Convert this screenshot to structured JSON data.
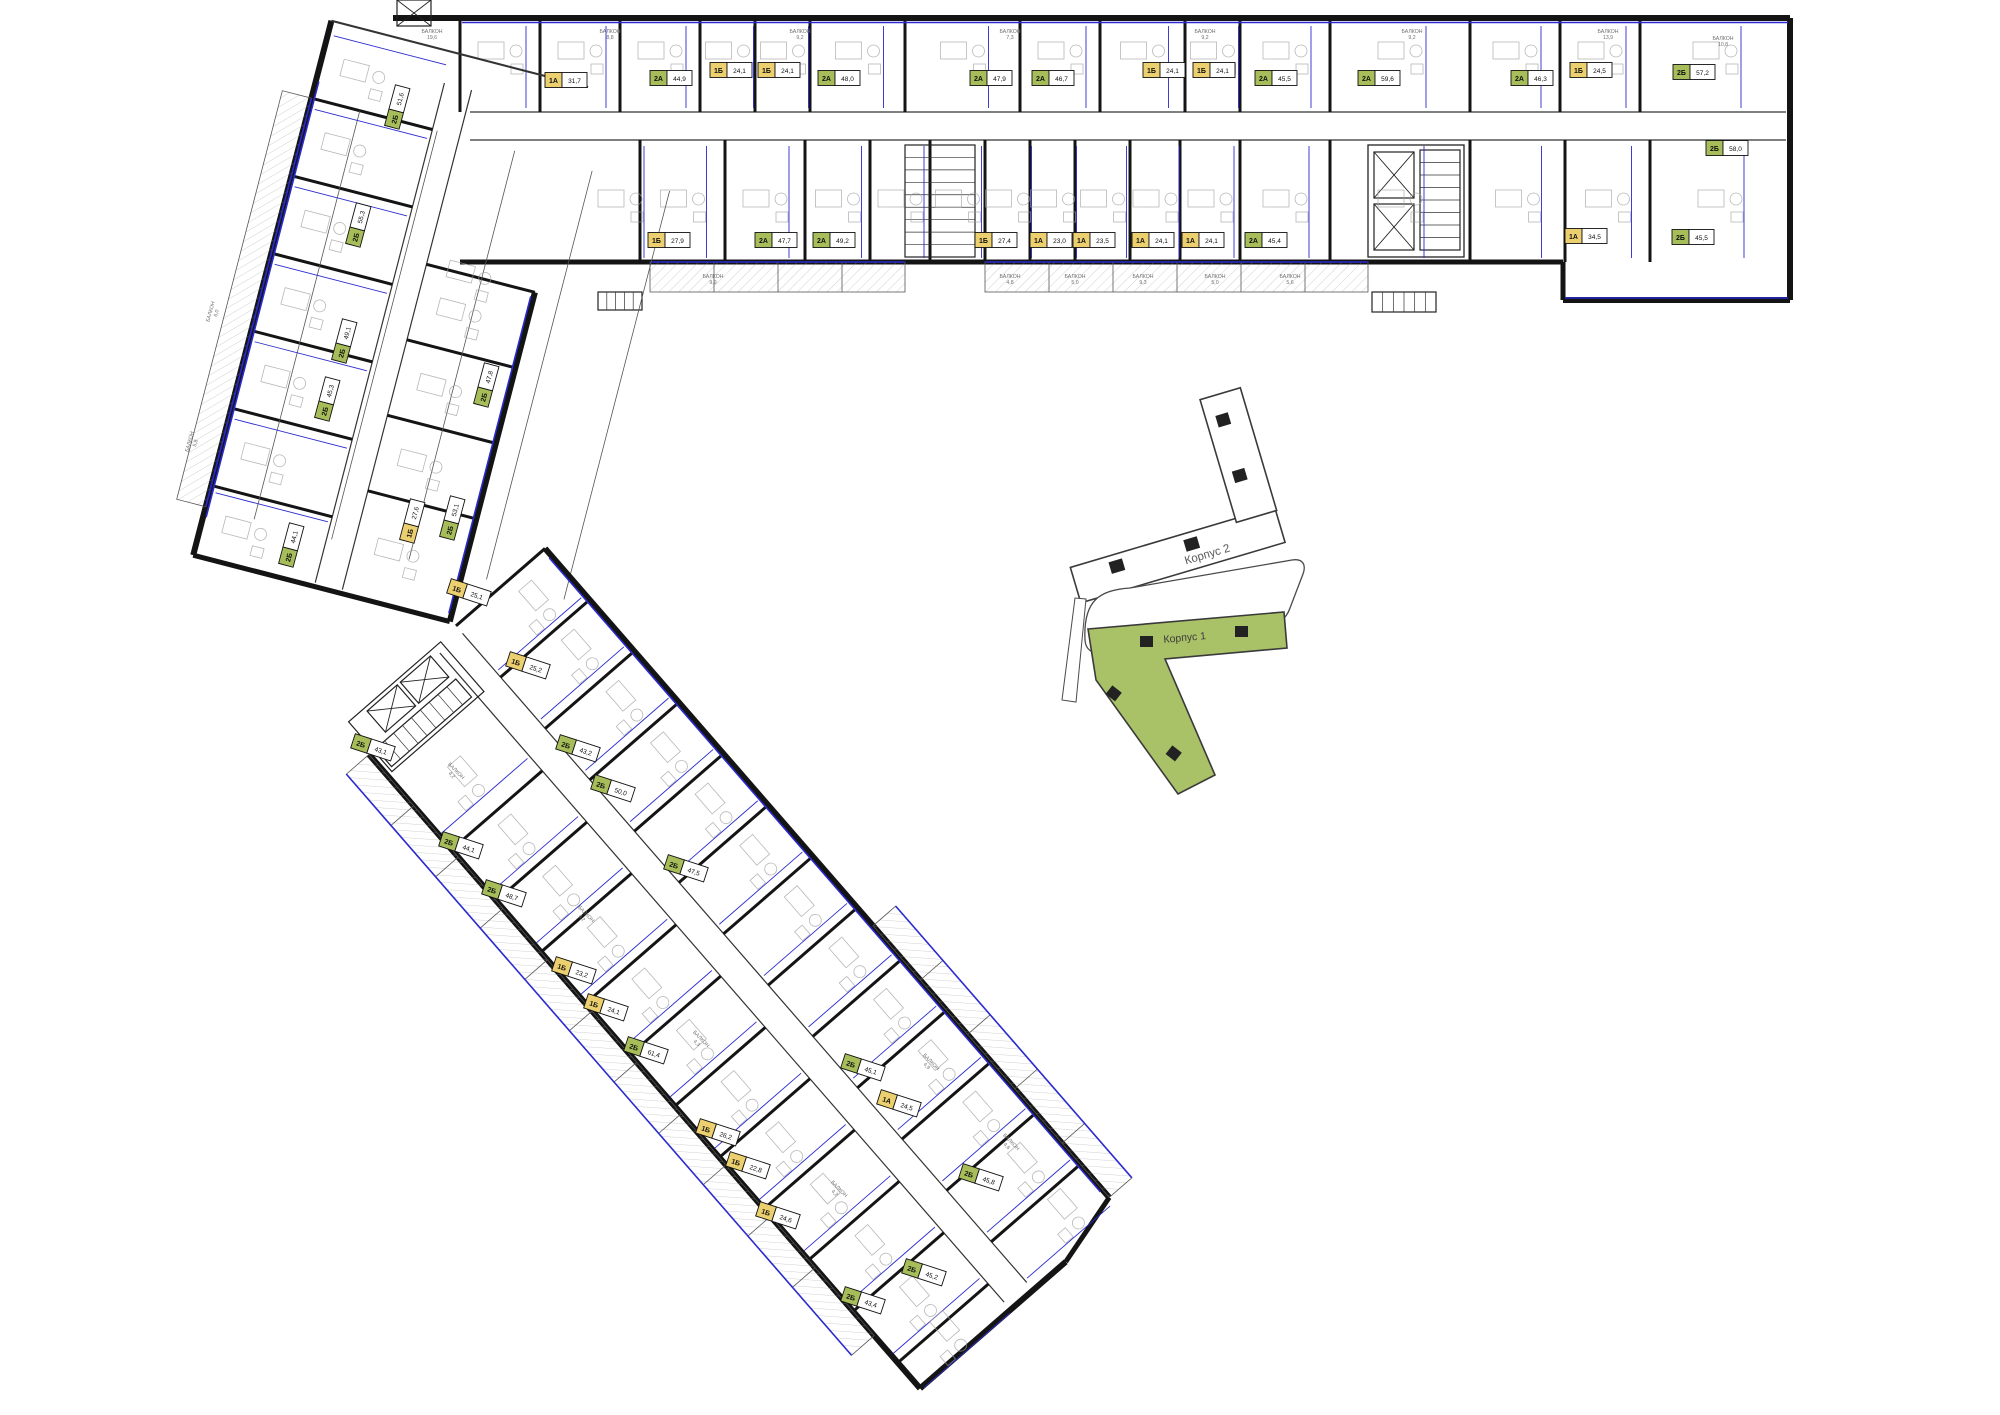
{
  "title": "Поэтажный план — Корпус 1",
  "key_plan": {
    "building1_label": "Корпус 1",
    "building2_label": "Корпус 2",
    "highlight_color": "#a9c167"
  },
  "colors": {
    "wall": "#141414",
    "thin": "#555555",
    "window_blue": "#2a2ad0",
    "type1_yellow": "#ecd06f",
    "type2_green": "#a6bd59",
    "balcony_text": "#707070",
    "furniture": "#a0a0a0"
  },
  "balcony_label": "БАЛКОН",
  "units": [
    {
      "t": "1А",
      "a": "31,7",
      "x": 565,
      "y": 80,
      "r": 0
    },
    {
      "t": "2А",
      "a": "44,9",
      "x": 670,
      "y": 78,
      "r": 0
    },
    {
      "t": "1Б",
      "a": "24,1",
      "x": 730,
      "y": 70,
      "r": 0
    },
    {
      "t": "1Б",
      "a": "24,1",
      "x": 778,
      "y": 70,
      "r": 0
    },
    {
      "t": "2А",
      "a": "48,0",
      "x": 838,
      "y": 78,
      "r": 0
    },
    {
      "t": "2А",
      "a": "47,9",
      "x": 990,
      "y": 78,
      "r": 0
    },
    {
      "t": "2А",
      "a": "46,7",
      "x": 1052,
      "y": 78,
      "r": 0
    },
    {
      "t": "1Б",
      "a": "24,1",
      "x": 1163,
      "y": 70,
      "r": 0
    },
    {
      "t": "1Б",
      "a": "24,1",
      "x": 1213,
      "y": 70,
      "r": 0
    },
    {
      "t": "2А",
      "a": "45,5",
      "x": 1275,
      "y": 78,
      "r": 0
    },
    {
      "t": "2А",
      "a": "59,6",
      "x": 1378,
      "y": 78,
      "r": 0
    },
    {
      "t": "2А",
      "a": "46,3",
      "x": 1531,
      "y": 78,
      "r": 0
    },
    {
      "t": "1Б",
      "a": "24,5",
      "x": 1590,
      "y": 70,
      "r": 0
    },
    {
      "t": "2Б",
      "a": "57,2",
      "x": 1693,
      "y": 72,
      "r": 0
    },
    {
      "t": "2Б",
      "a": "58,0",
      "x": 1726,
      "y": 148,
      "r": 0
    },
    {
      "t": "1Б",
      "a": "27,9",
      "x": 668,
      "y": 240,
      "r": 0
    },
    {
      "t": "2А",
      "a": "47,7",
      "x": 775,
      "y": 240,
      "r": 0
    },
    {
      "t": "2А",
      "a": "49,2",
      "x": 833,
      "y": 240,
      "r": 0
    },
    {
      "t": "1Б",
      "a": "27,4",
      "x": 995,
      "y": 240,
      "r": 0
    },
    {
      "t": "1А",
      "a": "23,0",
      "x": 1050,
      "y": 240,
      "r": 0
    },
    {
      "t": "1А",
      "a": "23,5",
      "x": 1093,
      "y": 240,
      "r": 0
    },
    {
      "t": "1А",
      "a": "24,1",
      "x": 1152,
      "y": 240,
      "r": 0
    },
    {
      "t": "1А",
      "a": "24,1",
      "x": 1202,
      "y": 240,
      "r": 0
    },
    {
      "t": "2А",
      "a": "45,4",
      "x": 1265,
      "y": 240,
      "r": 0
    },
    {
      "t": "1А",
      "a": "34,5",
      "x": 1585,
      "y": 236,
      "r": 0
    },
    {
      "t": "2Б",
      "a": "45,5",
      "x": 1692,
      "y": 237,
      "r": 0
    },
    {
      "t": "2Б",
      "a": "51,6",
      "x": 397,
      "y": 108,
      "r": -75
    },
    {
      "t": "2Б",
      "a": "55,3",
      "x": 358,
      "y": 226,
      "r": -75
    },
    {
      "t": "2Б",
      "a": "49,1",
      "x": 344,
      "y": 342,
      "r": -75
    },
    {
      "t": "2Б",
      "a": "45,3",
      "x": 327,
      "y": 400,
      "r": -75
    },
    {
      "t": "2Б",
      "a": "44,1",
      "x": 291,
      "y": 546,
      "r": -75
    },
    {
      "t": "2Б",
      "a": "47,8",
      "x": 486,
      "y": 386,
      "r": -75
    },
    {
      "t": "2Б",
      "a": "53,1",
      "x": 452,
      "y": 519,
      "r": -75
    },
    {
      "t": "1Б",
      "a": "27,6",
      "x": 412,
      "y": 522,
      "r": -75
    },
    {
      "t": "1Б",
      "a": "25,2",
      "x": 527,
      "y": 665,
      "r": 18
    },
    {
      "t": "2Б",
      "a": "43,2",
      "x": 577,
      "y": 748,
      "r": 18
    },
    {
      "t": "2Б",
      "a": "50,0",
      "x": 612,
      "y": 788,
      "r": 18
    },
    {
      "t": "2Б",
      "a": "47,5",
      "x": 685,
      "y": 868,
      "r": 18
    },
    {
      "t": "2Б",
      "a": "45,1",
      "x": 862,
      "y": 1067,
      "r": 18
    },
    {
      "t": "1А",
      "a": "24,5",
      "x": 898,
      "y": 1103,
      "r": 18
    },
    {
      "t": "2Б",
      "a": "45,8",
      "x": 980,
      "y": 1177,
      "r": 18
    },
    {
      "t": "2Б",
      "a": "43,1",
      "x": 372,
      "y": 747,
      "r": 18
    },
    {
      "t": "2Б",
      "a": "44,1",
      "x": 460,
      "y": 845,
      "r": 18
    },
    {
      "t": "2Б",
      "a": "48,7",
      "x": 503,
      "y": 893,
      "r": 18
    },
    {
      "t": "1Б",
      "a": "25,1",
      "x": 468,
      "y": 592,
      "r": 18
    },
    {
      "t": "1Б",
      "a": "23,2",
      "x": 573,
      "y": 970,
      "r": 18
    },
    {
      "t": "1Б",
      "a": "24,1",
      "x": 605,
      "y": 1007,
      "r": 18
    },
    {
      "t": "2Б",
      "a": "61,4",
      "x": 645,
      "y": 1050,
      "r": 18
    },
    {
      "t": "1Б",
      "a": "26,2",
      "x": 717,
      "y": 1132,
      "r": 18
    },
    {
      "t": "1Б",
      "a": "22,8",
      "x": 747,
      "y": 1165,
      "r": 18
    },
    {
      "t": "1Б",
      "a": "24,6",
      "x": 777,
      "y": 1215,
      "r": 18
    },
    {
      "t": "2Б",
      "a": "45,2",
      "x": 923,
      "y": 1272,
      "r": 18
    },
    {
      "t": "2Б",
      "a": "43,4",
      "x": 862,
      "y": 1300,
      "r": 18
    }
  ],
  "balconies": [
    {
      "a": "19,6",
      "x": 432,
      "y": 33,
      "r": 0
    },
    {
      "a": "8,8",
      "x": 610,
      "y": 33,
      "r": 0
    },
    {
      "a": "9,2",
      "x": 800,
      "y": 33,
      "r": 0
    },
    {
      "a": "7,3",
      "x": 1010,
      "y": 33,
      "r": 0
    },
    {
      "a": "9,2",
      "x": 1205,
      "y": 33,
      "r": 0
    },
    {
      "a": "9,2",
      "x": 1412,
      "y": 33,
      "r": 0
    },
    {
      "a": "13,9",
      "x": 1608,
      "y": 33,
      "r": 0
    },
    {
      "a": "10,8",
      "x": 1723,
      "y": 40,
      "r": 0
    },
    {
      "a": "9,9",
      "x": 713,
      "y": 278,
      "r": 0
    },
    {
      "a": "4,8",
      "x": 1010,
      "y": 278,
      "r": 0
    },
    {
      "a": "5,0",
      "x": 1075,
      "y": 278,
      "r": 0
    },
    {
      "a": "9,3",
      "x": 1143,
      "y": 278,
      "r": 0
    },
    {
      "a": "5,0",
      "x": 1215,
      "y": 278,
      "r": 0
    },
    {
      "a": "5,6",
      "x": 1290,
      "y": 278,
      "r": 0
    },
    {
      "a": "6,0",
      "x": 212,
      "y": 312,
      "r": -75
    },
    {
      "a": "5,8",
      "x": 191,
      "y": 442,
      "r": -75
    },
    {
      "a": "4,2",
      "x": 455,
      "y": 772,
      "r": 46
    },
    {
      "a": "4,2",
      "x": 585,
      "y": 915,
      "r": 46
    },
    {
      "a": "4,3",
      "x": 700,
      "y": 1040,
      "r": 46
    },
    {
      "a": "4,2",
      "x": 838,
      "y": 1190,
      "r": 46
    },
    {
      "a": "4,9",
      "x": 930,
      "y": 1063,
      "r": 46
    },
    {
      "a": "4,6",
      "x": 1010,
      "y": 1143,
      "r": 46
    }
  ]
}
